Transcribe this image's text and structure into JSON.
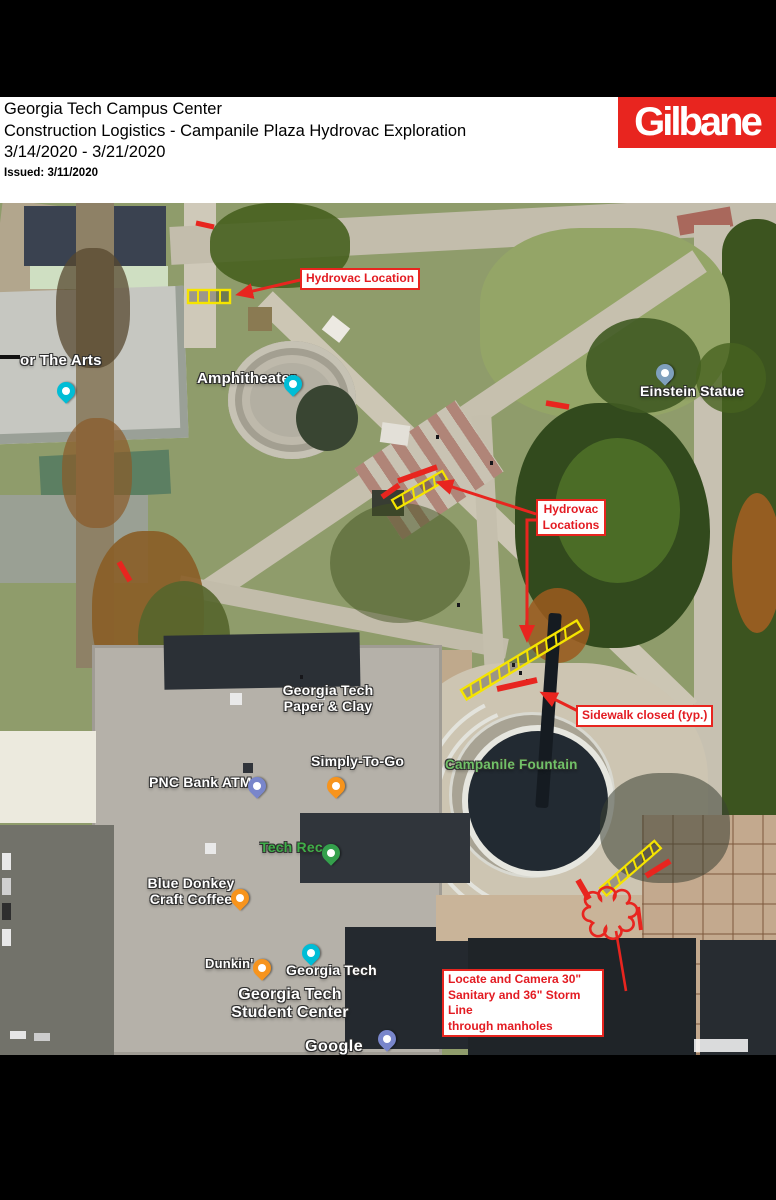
{
  "header": {
    "line1": "Georgia Tech Campus Center",
    "line2": "Construction Logistics - Campanile Plaza Hydrovac Exploration",
    "line3": "3/14/2020 - 3/21/2020",
    "issued": "Issued: 3/11/2020",
    "logo": "Gilbane"
  },
  "colors": {
    "annotation_red": "#e8251f",
    "hatch_yellow": "#f5e400",
    "logo_red": "#e8251f",
    "poi_label_green": "#3fae49",
    "fountain_label_green": "#71c168",
    "pin_teal": "#00bdd6",
    "pin_orange": "#f7941d",
    "pin_green": "#34a04c",
    "pin_indigo": "#7986cb",
    "pin_slate_blue": "#7fa0bd"
  },
  "callouts": {
    "hydrovac_location": "Hydrovac Location",
    "hydrovac_locations": "Hydrovac\nLocations",
    "sidewalk_closed": "Sidewalk closed (typ.)",
    "locate_camera": "Locate and Camera 30\"\nSanitary and 36\" Storm Line\nthrough manholes"
  },
  "map": {
    "watermark": "Google",
    "labels": {
      "arts": "or The Arts",
      "amphitheater": "Amphitheater",
      "einstein_statue": "Einstein Statue",
      "paper_clay": "Georgia Tech\nPaper & Clay",
      "pnc_bank_atm": "PNC Bank ATM",
      "simply_to_go": "Simply-To-Go",
      "tech_rec": "Tech Rec",
      "campanile_fountain": "Campanile Fountain",
      "blue_donkey": "Blue Donkey\nCraft Coffee",
      "dunkin": "Dunkin'",
      "georgia_tech": "Georgia Tech",
      "student_center": "Georgia Tech\nStudent Center"
    }
  }
}
